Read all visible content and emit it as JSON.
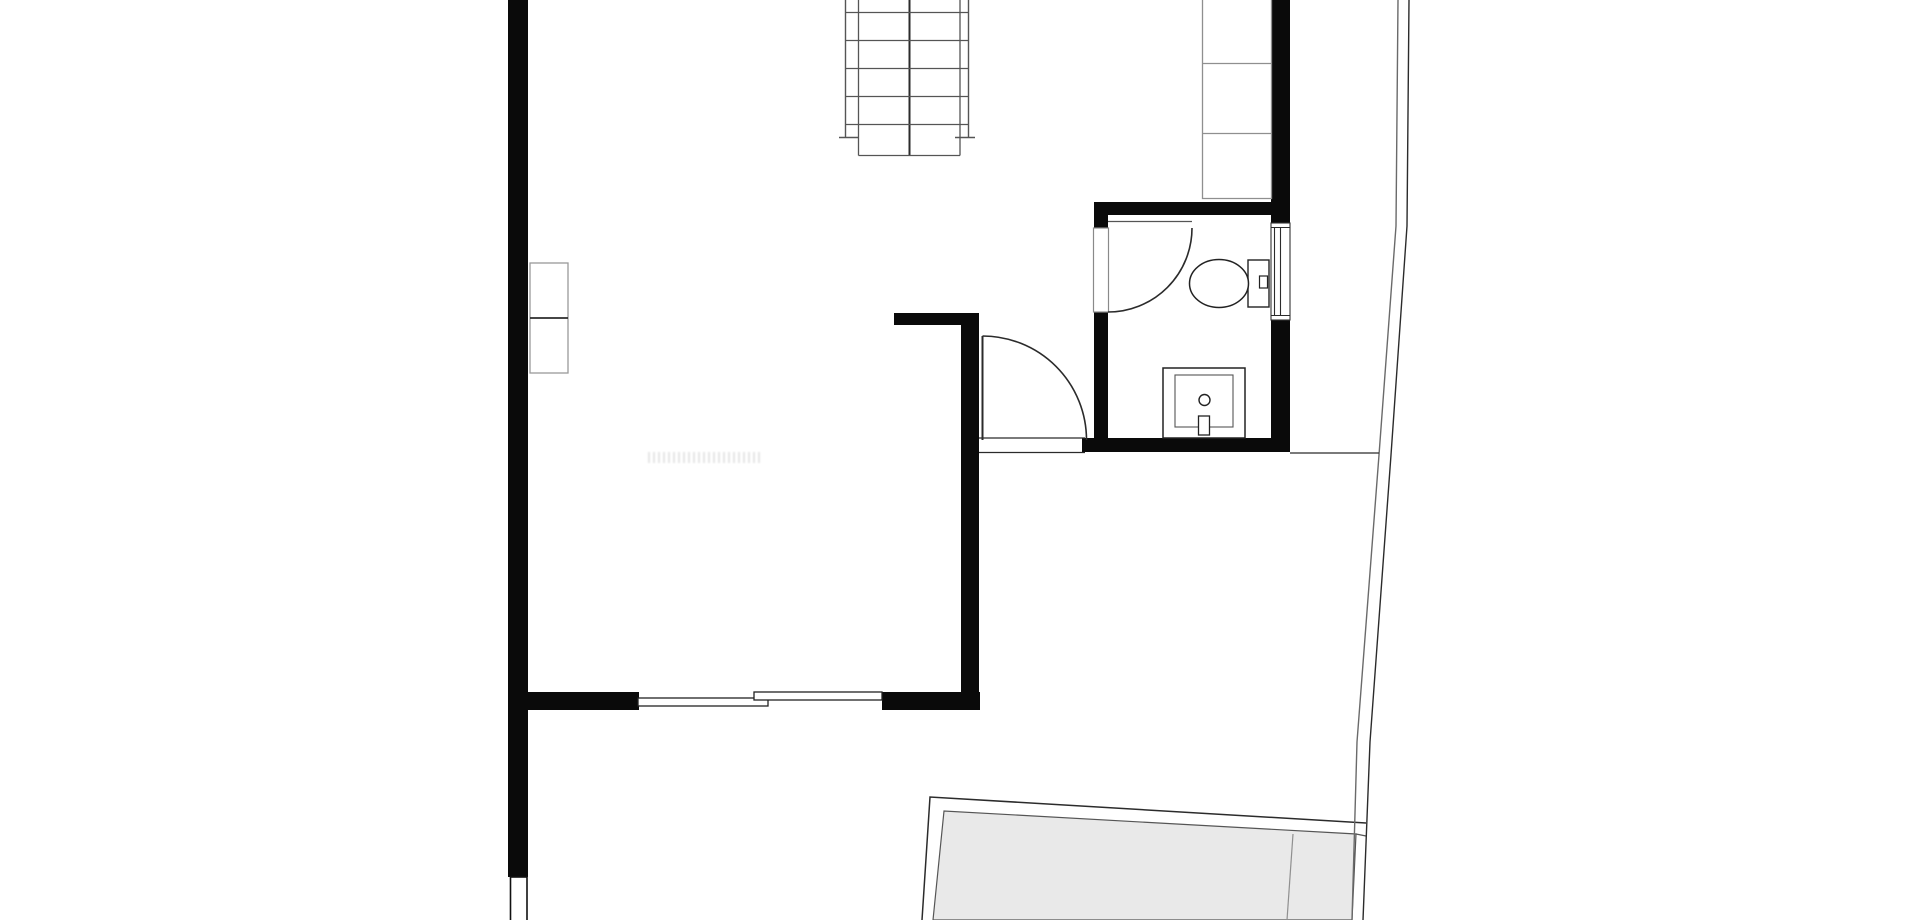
{
  "document": {
    "type": "architectural-floor-plan",
    "view": "top-down",
    "visible_text": "none (only a faint illegible watermark smudge in the main room)"
  },
  "colors": {
    "background": "#ffffff",
    "wall": "#0a0a0a",
    "ink": "#2b2b2b",
    "mid": "#555555",
    "light": "#8f8f8f",
    "boundary": "#6a6a6a",
    "terrace_fill": "#e9e9e9"
  },
  "elements": {
    "staircase": {
      "tread_columns": 2,
      "visible_tread_rows": 6,
      "center_divider": true,
      "position": "top-center, cut off by top edge"
    },
    "closet_top_right": {
      "sections": 3,
      "against_wall": "right"
    },
    "wall_cabinet_left": {
      "sections": 2,
      "against_wall": "left"
    },
    "bathroom": {
      "fixtures": [
        "toilet-with-tank",
        "washbasin-with-faucet",
        "window-in-right-wall"
      ],
      "door": "hinged, swings into bathroom"
    },
    "doors": [
      {
        "name": "bathroom-door",
        "type": "hinged",
        "quarter_swing_arc": true
      },
      {
        "name": "hallway-door",
        "type": "hinged",
        "quarter_swing_arc": true
      },
      {
        "name": "patio-door",
        "type": "sliding",
        "panels": 2
      }
    ],
    "terrace": {
      "fill": "light-gray",
      "shape": "slanted quadrilateral, cut off by bottom edge",
      "inner_divider_line": true
    },
    "property_boundary": {
      "style": "double thin line",
      "runs": "top to bottom on right side, slightly slanted"
    },
    "watermark": {
      "legible": false
    }
  }
}
